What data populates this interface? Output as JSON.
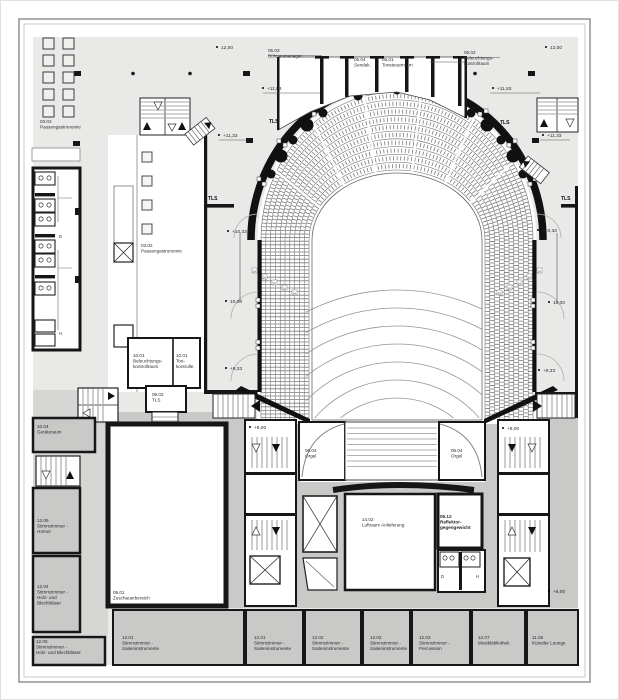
{
  "drawing_type": "concert-hall-floor-plan",
  "colors": {
    "plate": "#e9e9e8",
    "room_gray": "#c9c9c8",
    "wall": "#161616",
    "accent_white": "#ffffff"
  },
  "rooms": {
    "r0503": [
      "05.03",
      "Bühnenmanager"
    ],
    "r0504": [
      "05.04",
      "Sendek."
    ],
    "r0501": [
      "05.01",
      "Tonsteuerraum"
    ],
    "r0502": [
      "05.02",
      "Beleuchtungs-",
      "kontrollraum"
    ],
    "r0302a": [
      "03.02",
      "Pausengastronomie"
    ],
    "r0302b": [
      "03.02",
      "Pausengastronomie"
    ],
    "r1001a": [
      "10.01",
      "Beleuchtungs-",
      "kontrollraum"
    ],
    "r1001b": [
      "10.01",
      "Ton-",
      "kontrolle."
    ],
    "r0902": [
      "09.02",
      "TLS"
    ],
    "r1004": [
      "10.04",
      "Geräteraum"
    ],
    "r1206": [
      "12.06",
      "Stimmzimmer -",
      "Hörner"
    ],
    "r1204": [
      "12.04",
      "Stimmzimmer -",
      "Holz- und",
      "Blechbläser"
    ],
    "r1205": [
      "12.05",
      "Stimmzimmer -",
      "Holz- und Blechbläser"
    ],
    "r0901": [
      "09.01",
      "Zuschauerbereich"
    ],
    "r0604l": [
      "06.04",
      "Orgel"
    ],
    "r0604r": [
      "06.04",
      "Orgel"
    ],
    "r1402": [
      "14.02",
      "Luftraum Anlieferung"
    ],
    "r0612": [
      "06.12",
      "Reflektor-",
      "gegengewicht"
    ],
    "r1201a": [
      "12.01",
      "Stimmzimmer -",
      "Saiteninstrumente"
    ],
    "r1201b": [
      "12.01",
      "Stimmzimmer -",
      "Saiteninstrumente"
    ],
    "r1202a": [
      "12.02",
      "Stimmzimmer -",
      "Saiteninstrumente"
    ],
    "r1202b": [
      "12.02",
      "Stimmzimmer -",
      "Saiteninstrumente"
    ],
    "r1203": [
      "12.03",
      "Stimmzimmer -",
      "Percussion"
    ],
    "r1207": [
      "12.07",
      "Musikbibliothek"
    ],
    "r1105": [
      "11.05",
      "Künstler Lounge"
    ]
  },
  "levels": {
    "v1200": "12,00",
    "v1183": "+11,83",
    "v1133": "+11,33",
    "v1033": "+10,33",
    "v1000": "10,00",
    "v933": "+9,33",
    "v800": "+8,00"
  },
  "markers": {
    "tls": "TLS",
    "seat_row": "24",
    "wc_d": "D",
    "wc_h": "H"
  }
}
